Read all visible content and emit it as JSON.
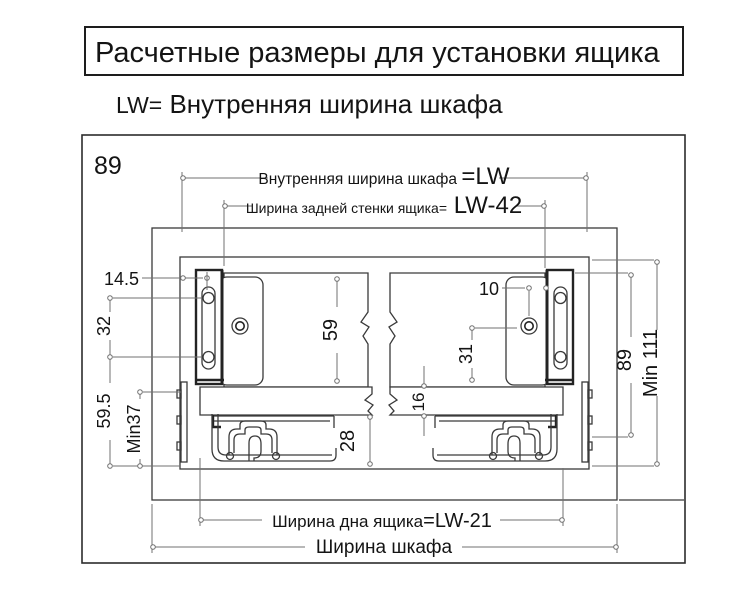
{
  "page": {
    "background": "#ffffff",
    "line_color": "#3a3a3a",
    "dim_line_color": "#707070",
    "text_color": "#141414"
  },
  "title": "Расчетные размеры для установки ящика",
  "subtitle": {
    "prefix": "LW=",
    "text": " Внутренняя ширина шкафа"
  },
  "diagram": {
    "corner_label": "89",
    "dims": {
      "inner_width": {
        "label": "Внутренняя ширина шкафа ",
        "value": "=LW"
      },
      "back_wall_width": {
        "label": "Ширина задней стенки ящика=",
        "value": " LW-42"
      },
      "bottom_width": {
        "label": "Ширина дна ящика",
        "value": "=LW-21"
      },
      "cabinet_width": "Ширина шкафа",
      "front_offset": "14.5",
      "hole_spacing": "32",
      "bottom_offset": "59.5",
      "min_rail_clearance": "Min37",
      "back_panel_height": "59",
      "under_bottom_gap": "28",
      "bottom_thickness": "16",
      "hole_side_offset": "10",
      "hole_height": "31",
      "side_height": "89",
      "min_inner_height": "Min 111"
    }
  }
}
